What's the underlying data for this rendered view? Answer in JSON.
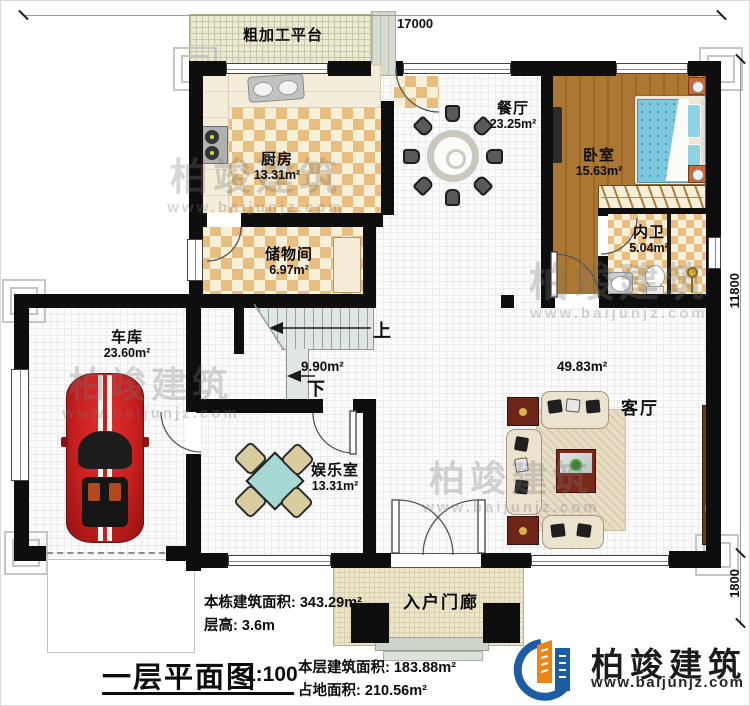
{
  "dimensions": {
    "top": "17000",
    "right": "11800",
    "right_lower": "1800"
  },
  "rooms": {
    "platform": {
      "name": "粗加工平台"
    },
    "kitchen": {
      "name": "厨房",
      "area": "13.31m²"
    },
    "dining": {
      "name": "餐厅",
      "area": "23.25m²"
    },
    "bedroom": {
      "name": "卧室",
      "area": "15.63m²"
    },
    "bathroom": {
      "name": "内卫",
      "area": "5.04m²"
    },
    "storage": {
      "name": "储物间",
      "area": "6.97m²"
    },
    "garage": {
      "name": "车库",
      "area": "23.60m²"
    },
    "entertainment": {
      "name": "娱乐室",
      "area": "13.31m²"
    },
    "living": {
      "name": "客厅",
      "area": "49.83m²"
    },
    "stairs": {
      "area": "9.90m²",
      "up": "上",
      "down": "下"
    },
    "porch": {
      "name": "入户门廊"
    }
  },
  "info": {
    "total_area": {
      "label": "本栋建筑面积:",
      "value": "343.29m²"
    },
    "floor_height": {
      "label": "层高:",
      "value": "3.6m"
    },
    "title": "一层平面图",
    "scale": "1:100",
    "floor_area": {
      "label": "本层建筑面积:",
      "value": "183.88m²"
    },
    "footprint": {
      "label": "占地面积:",
      "value": "210.56m²"
    }
  },
  "brand": {
    "name": "柏竣建筑",
    "url": "www.baijunjz.com"
  },
  "watermark": {
    "text": "柏竣建筑",
    "url": "www.baijunjz.com"
  },
  "colors": {
    "wall": "#0e0e0e",
    "tile_tan": "#e8bd80",
    "wood": "#a8742f",
    "bed_blue": "#7cc8de",
    "car_red": "#c81f1f",
    "accent_orange": "#ef8416",
    "accent_blue": "#1b5ca5"
  }
}
